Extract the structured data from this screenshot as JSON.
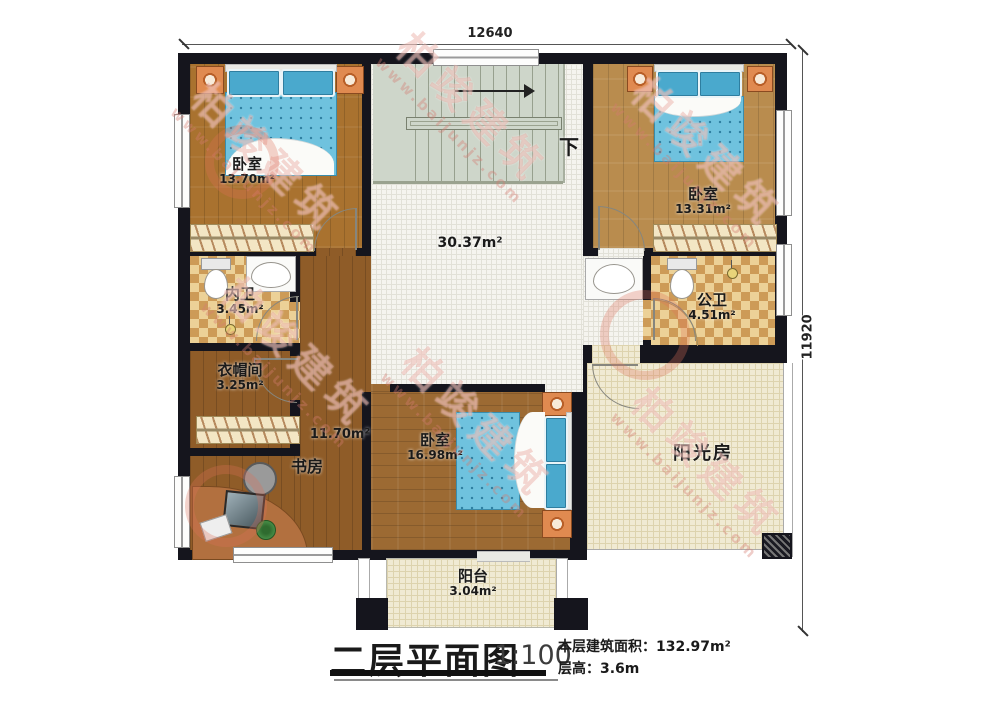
{
  "meta": {
    "doc_type": "residential floor plan, second storey"
  },
  "dimensions": {
    "top": "12640",
    "right": "11920"
  },
  "hall": {
    "area": "30.37m²"
  },
  "stairs": {
    "down": "下"
  },
  "rooms": {
    "bedroom_tl": {
      "name": "卧室",
      "area": "13.70m²"
    },
    "bedroom_tr": {
      "name": "卧室",
      "area": "13.31m²"
    },
    "bath_inner": {
      "name": "内卫",
      "area": "3.45m²"
    },
    "bath_public": {
      "name": "公卫",
      "area": "4.51m²"
    },
    "cloakroom": {
      "name": "衣帽间",
      "area": "3.25m²"
    },
    "study": {
      "name": "书房",
      "area": "11.70m²"
    },
    "bedroom_b": {
      "name": "卧室",
      "area": "16.98m²"
    },
    "sunroom": {
      "name": "阳光房"
    },
    "balcony": {
      "name": "阳台",
      "area": "3.04m²"
    }
  },
  "title_block": {
    "title": "二层平面图",
    "scale": "1:100",
    "area_text": "本层建筑面积：132.97m²",
    "height_text": "层高：3.6m"
  },
  "watermark": {
    "brand": "柏竣建筑",
    "url": "www.baijunjz.com"
  },
  "colors": {
    "wall": "#15151d",
    "wood_light": "#b98c4e",
    "wood_mid": "#a9722f",
    "wood_dark": "#8f5c28",
    "bath_tile": "#cd9b57",
    "hall_tile": "#f5f4ef",
    "stair": "#ced6ca",
    "sun_floor": "#f0ead3",
    "bed_blue": "#6fc2de",
    "nightstand_orange": "#e08a50",
    "watermark_red": "#e28a7c"
  }
}
